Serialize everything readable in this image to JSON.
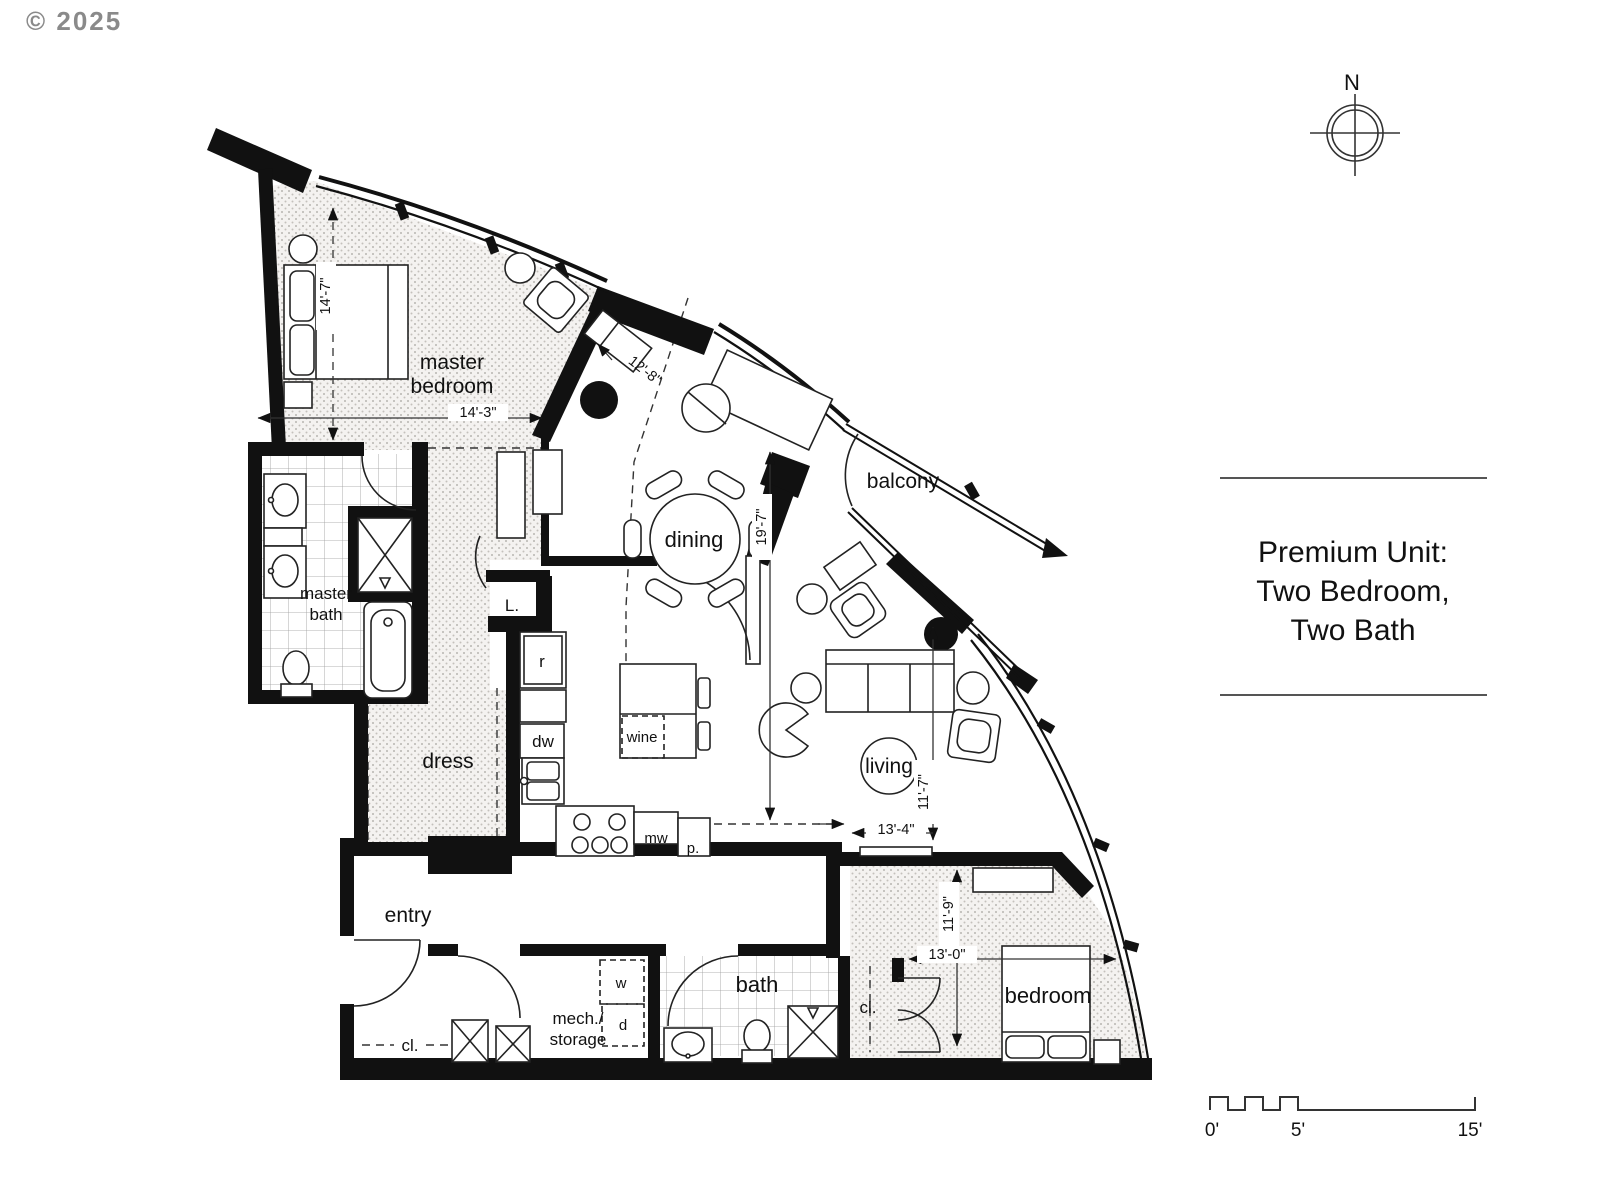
{
  "copyright": "© 2025",
  "compass": {
    "north_label": "N"
  },
  "title_block": {
    "line1": "Premium Unit:",
    "line2": "Two Bedroom,",
    "line3": "Two Bath"
  },
  "rooms": {
    "master_bedroom": [
      "master",
      "bedroom"
    ],
    "master_bath": [
      "master",
      "bath"
    ],
    "dress": "dress",
    "entry": "entry",
    "dining": "dining",
    "living": "living",
    "balcony": "balcony",
    "bath": "bath",
    "bedroom": "bedroom",
    "mech_storage": [
      "mech./",
      "storage"
    ],
    "closet_entry": "cl.",
    "closet_bedroom": "cl.",
    "linen": "L."
  },
  "fixtures": {
    "refrigerator": "r",
    "dishwasher": "dw",
    "microwave": "mw",
    "pantry": "p.",
    "wine": "wine",
    "washer": "w",
    "dryer": "d"
  },
  "dimensions": {
    "master_bedroom_depth": "14'-7\"",
    "master_bedroom_width": "14'-3\"",
    "window_bay": "12'-8\"",
    "great_room_depth": "19'-7\"",
    "living_width": "11'-7\"",
    "living_depth": "13'-4\"",
    "bedroom_depth": "11'-9\"",
    "bedroom_width": "13'-0\""
  },
  "scale_bar": {
    "start": "0'",
    "mid": "5'",
    "end": "15'"
  },
  "colors": {
    "wall": "#111111",
    "thin_line": "#222222",
    "dash_line": "#333333",
    "stipple_dot": "#b8b5b0",
    "tile_line": "#9a9a9a",
    "muted_text": "#8a8a8a"
  }
}
